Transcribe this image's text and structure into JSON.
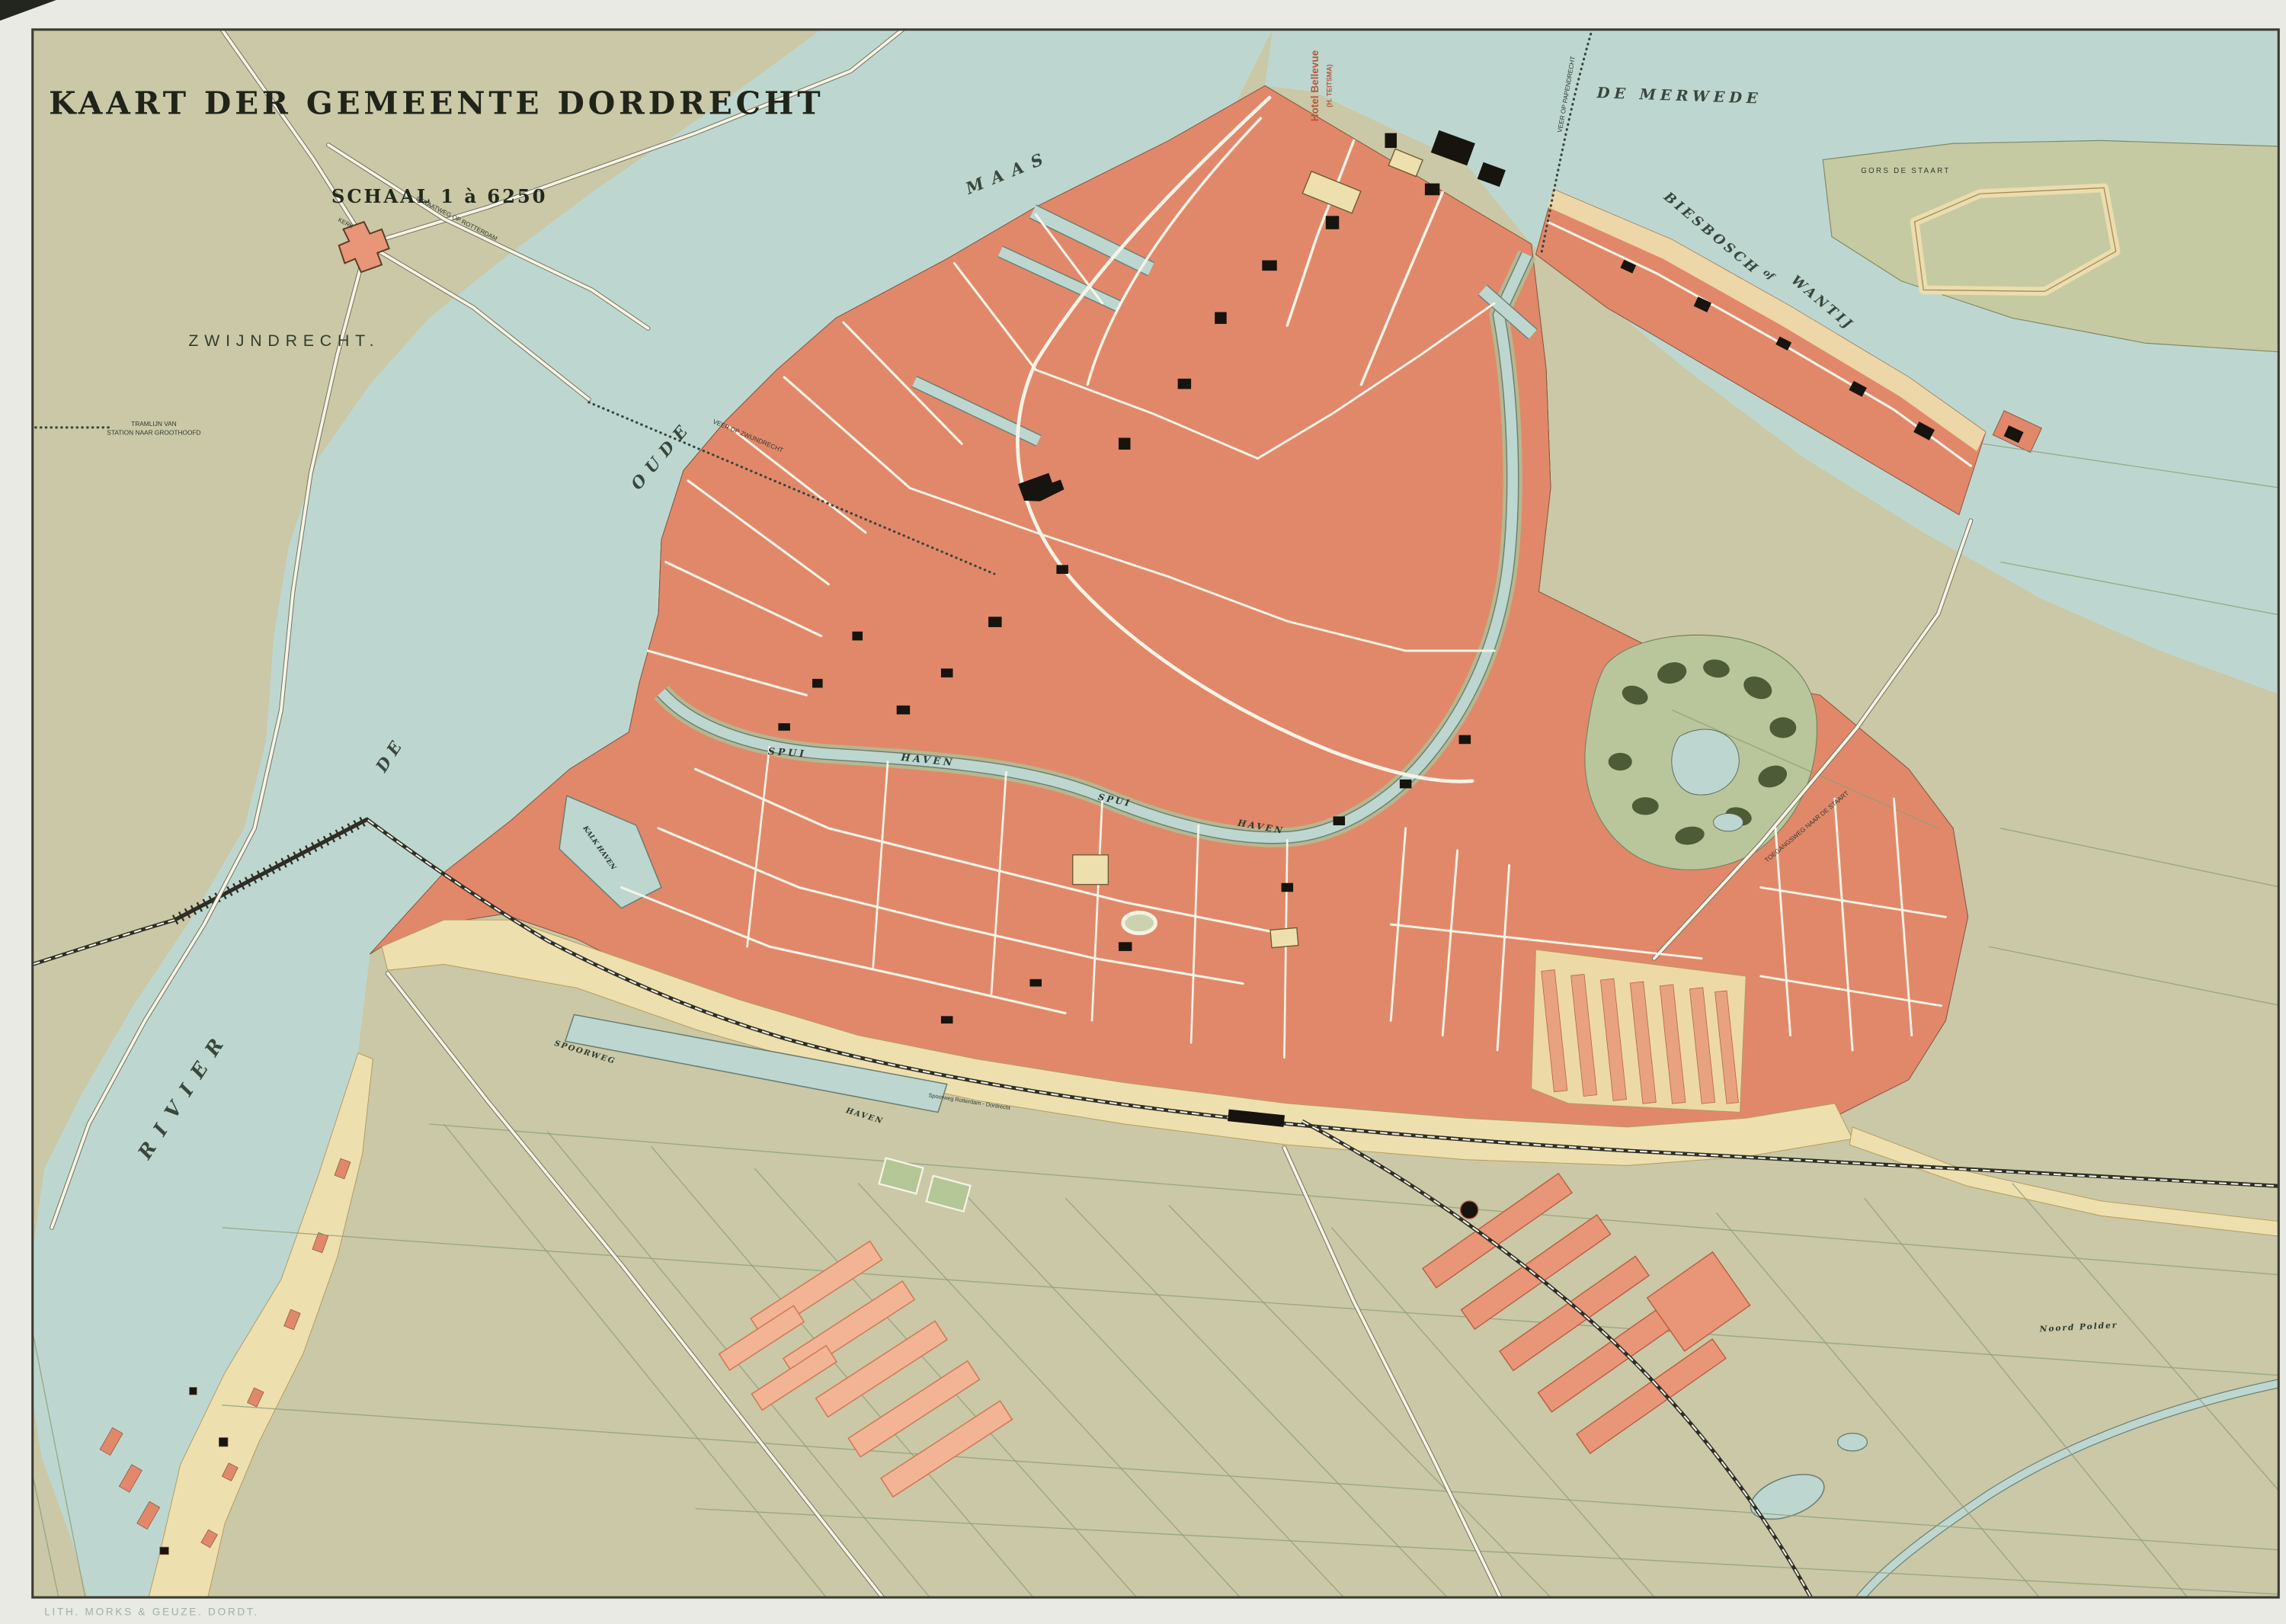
{
  "map": {
    "title": "KAART DER GEMEENTE DORDRECHT",
    "scale_label": "SCHAAL 1 à 6250",
    "credit": "LITH. MORKS & GEUZE. DORDT.",
    "labels": {
      "zwijndrecht": "ZWIJNDRECHT.",
      "kerk": "KERK",
      "tramlijn_1": "TRAMLIJN VAN",
      "tramlijn_2": "STATION NAAR GROOTHOOFD",
      "straatweg_rotterdam": "STRAATWEG OP ROTTERDAM",
      "rivier": "RIVIER",
      "de": "DE",
      "oude": "OUDE",
      "maas": "MAAS",
      "de_merwede": "DE  MERWEDE",
      "veer_op_papendrecht": "VEER OP PAPENDRECHT",
      "veer_op_zwijndrecht": "VEER OP ZWIJNDRECHT",
      "biesbosch": "BIESBOSCH",
      "of": "of",
      "wantij": "WANTIJ",
      "gors_de_staart": "GORS DE STAART",
      "hotel_bellevue": "Hotel Bellevue",
      "hotel_bellevue_sub": "(H. TEITSMA)",
      "spui_1": "SPUI",
      "haven_1": "HAVEN",
      "spui_2": "SPUI",
      "haven_2": "HAVEN",
      "kalk_haven": "KALK HAVEN",
      "spoorweg": "SPOORWEG",
      "spoorweg_haven": "HAVEN",
      "spoorweg_rotterdam_dordrecht": "Spoorweg Rotterdam - Dordrecht",
      "toegangsweg": "TOEGANGSWEG NAAR DE STAART",
      "noord_polder": "Noord  Polder"
    },
    "colors": {
      "margin": "#e8eae3",
      "paper": "#cac8a6",
      "water": "#bdd7d0",
      "city_block": "#e1886b",
      "city_hatch": "#a84f30",
      "dark_building": "#17140f",
      "cream": "#eedfae",
      "park_green": "#b9c69b",
      "tree_green": "#44522e",
      "road_white": "#f6f3e6",
      "pink_block": "#f3b496",
      "field_line": "#8f9e78",
      "frame": "#3c3c34",
      "label_dark": "#2f3a2f",
      "river_label": "#39473d",
      "hotel_red": "#b5573f",
      "credit_text": "#a2b1a7"
    }
  }
}
